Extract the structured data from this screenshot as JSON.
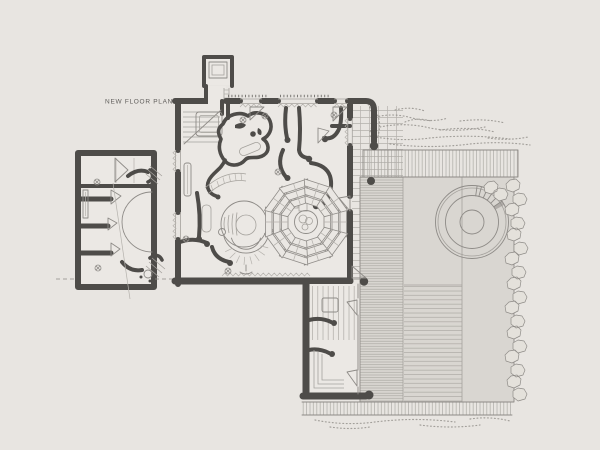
{
  "plan": {
    "label": "NEW FLOOR PLAN"
  },
  "palette": {
    "background": "#e8e5e1",
    "interior": "#ebe8e4",
    "wall": "#4e4c49",
    "line": "#8e8b87",
    "line_light": "#b4b1ac",
    "courtyard": "#d9d6d1",
    "circle_fill": "#dfdcd7",
    "circle_inner": "#d6d3ce",
    "vegetation": "#8b8883",
    "text": "#5f5d5a"
  }
}
